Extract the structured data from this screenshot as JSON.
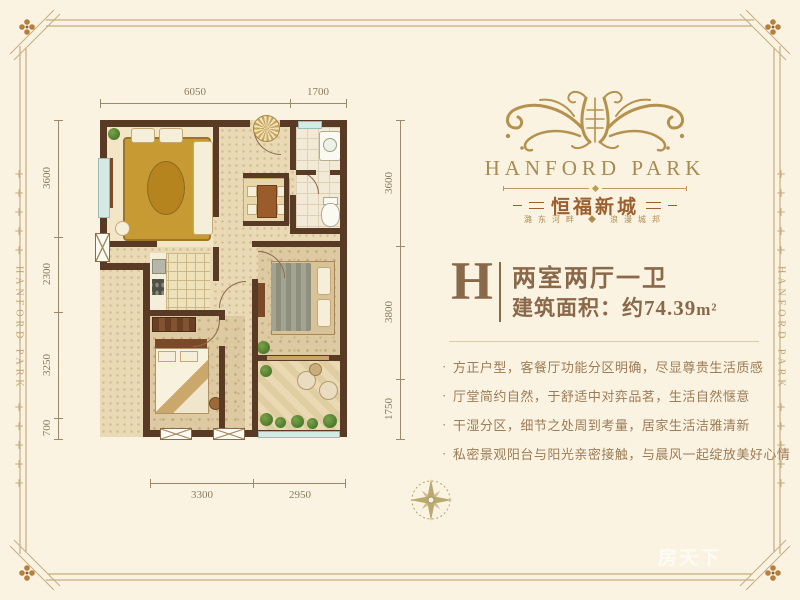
{
  "brand": {
    "name": "HANFORD PARK",
    "cn_name": "恒福新城",
    "tagline": "潞东河畔 ◆ 浪漫城邦"
  },
  "rails": {
    "text": "HANFORD PARK",
    "plus": "+"
  },
  "unit": {
    "letter": "H",
    "layout": "两室两厅一卫",
    "area": "建筑面积：约74.39",
    "area_unit": "m²"
  },
  "features": {
    "bullet": "·",
    "items": [
      "方正户型，客餐厅功能分区明确，尽显尊贵生活质感",
      "厅堂简约自然，于舒适中对弈品茗，生活自然惬意",
      "干湿分区，细节之处周到考量，居家生活洁雅清新",
      "私密景观阳台与阳光亲密接触，与晨风一起绽放美好心情"
    ]
  },
  "dimensions": {
    "top": [
      "6050",
      "1700"
    ],
    "left": [
      "3600",
      "2300",
      "3250",
      "700"
    ],
    "right": [
      "3600",
      "3800",
      "1750"
    ],
    "bottom": [
      "3300",
      "2950"
    ]
  },
  "watermark": {
    "text": "房天下"
  },
  "colors": {
    "background": "#fbf3e1",
    "frame_gold": "#c6ad82",
    "brand_gold": "#a88a54",
    "banner_red_brown": "#9c5f2e",
    "unit_brown": "#8a684a",
    "feature_brown": "#9c7c56",
    "wall_brown": "#583a25",
    "window_blue": "#d6e9e4"
  }
}
